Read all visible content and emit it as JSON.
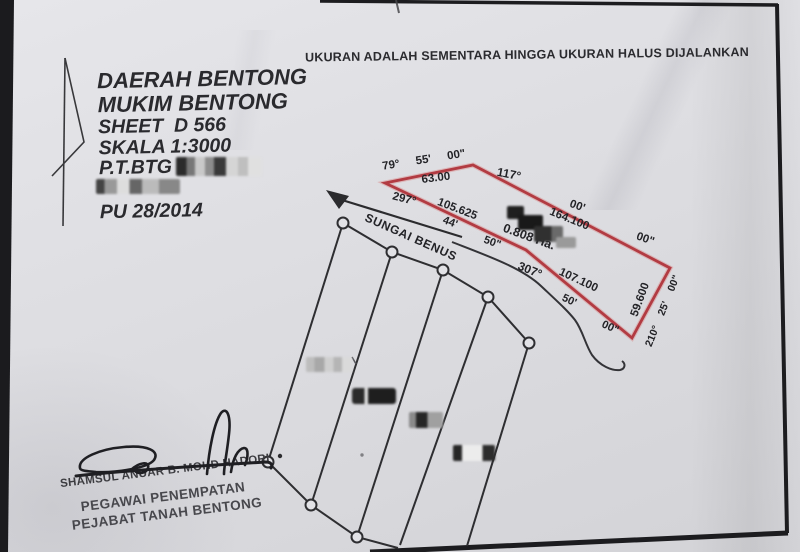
{
  "document": {
    "notice": "UKURAN ADALAH SEMENTARA HINGGA UKURAN HALUS DIJALANKAN",
    "title_block": {
      "lines": [
        "DAERAH BENTONG",
        "MUKIM BENTONG",
        "SHEET  D 566",
        "SKALA 1:3000",
        "P.T.BTG",
        "PU 28/2014"
      ]
    },
    "map": {
      "river_label": "SUNGAI BENUS",
      "area_label": "0.808 Ha.",
      "labels": [
        "79°  55'  00\"",
        "63.00",
        "117°",
        "00'",
        "164.100",
        "00\"",
        "297°",
        "105.625",
        "44'",
        "50\"",
        "307°",
        "107.100",
        "50'",
        "00\"",
        "59.600",
        "210°  25'  00\""
      ]
    },
    "stamp": {
      "name": "SHAMSUL ANUAR B. MOHD HADORI",
      "title": "PEGAWAI PENEMPATAN",
      "office": "PEJABAT TANAH BENTONG"
    },
    "colors": {
      "parcel_outline": "#b23b42",
      "ink": "#2e2e30",
      "paper": "#dfdfe3"
    }
  }
}
